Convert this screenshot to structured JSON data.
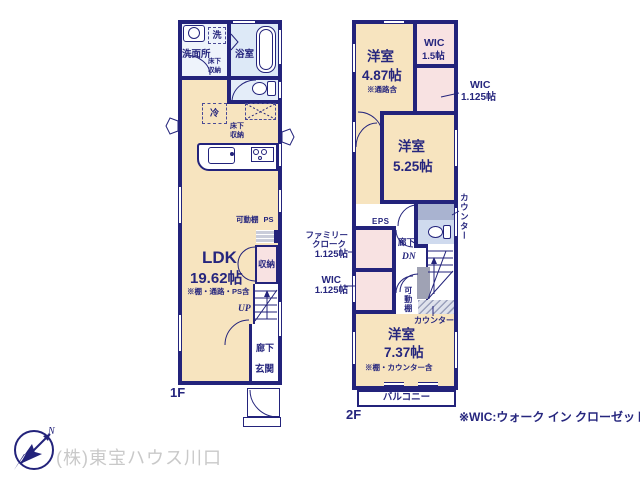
{
  "colors": {
    "wall": "#23237b",
    "text": "#26267e",
    "floor_tan": "#f7e4bf",
    "closet_pink": "#f8e2e2",
    "bath_blue": "#dde9f7",
    "toilet_blue": "#cfdaee",
    "counter_gray": "#a9b3d0",
    "company_gray": "#c9c9c9"
  },
  "footer": {
    "company": "(株)東宝ハウス川口",
    "wic_note": "※WIC:ウォーク イン クローゼット",
    "compass_n": "N"
  },
  "floor1": {
    "label": "1F",
    "washroom": "洗面所",
    "washer": "洗",
    "washroom_storage": "床下収納",
    "bathroom": "浴室",
    "fridge": "冷",
    "underfloor_storage": "床下収納",
    "movable_shelf": "可動棚",
    "ps": "PS",
    "ldk": {
      "name": "LDK",
      "size": "19.62帖",
      "note": "※棚・通路・PS含"
    },
    "closet": "収納",
    "up": "UP",
    "hallway": "廊下",
    "entrance": "玄関"
  },
  "floor2": {
    "label": "2F",
    "room1": {
      "name": "洋室",
      "size": "4.87帖",
      "note": "※通路含"
    },
    "wic_a": {
      "name": "WIC",
      "size": "1.5帖"
    },
    "wic_b": {
      "name": "WIC",
      "size": "1.125帖"
    },
    "room2": {
      "name": "洋室",
      "size": "5.25帖"
    },
    "counter_side": "カウンター",
    "eps": "EPS",
    "hallway": "廊下",
    "dn": "DN",
    "family_cloak": {
      "line1": "ファミリー",
      "line2": "クローク",
      "size": "1.125帖"
    },
    "wic_c": {
      "name": "WIC",
      "size": "1.125帖"
    },
    "movable_shelf": "可動棚",
    "counter_bottom": "カウンター",
    "room3": {
      "name": "洋室",
      "size": "7.37帖",
      "note": "※棚・カウンター含"
    },
    "balcony": "バルコニー"
  }
}
